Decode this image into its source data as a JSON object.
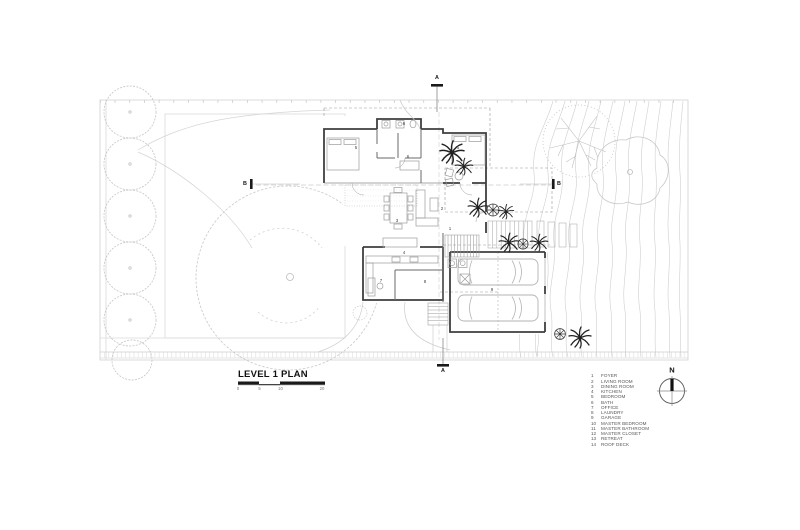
{
  "title_block": {
    "title": "LEVEL 1 PLAN",
    "scale_ticks": [
      "0",
      "5",
      "10",
      "20"
    ]
  },
  "north": {
    "label": "N"
  },
  "sections": {
    "a": "A",
    "b": "B"
  },
  "legend": {
    "items": [
      {
        "num": "1",
        "label": "FOYER"
      },
      {
        "num": "2",
        "label": "LIVING ROOM"
      },
      {
        "num": "3",
        "label": "DINING ROOM"
      },
      {
        "num": "4",
        "label": "KITCHEN"
      },
      {
        "num": "5",
        "label": "BEDROOM"
      },
      {
        "num": "6",
        "label": "BATH"
      },
      {
        "num": "7",
        "label": "OFFICE"
      },
      {
        "num": "8",
        "label": "LAUNDRY"
      },
      {
        "num": "9",
        "label": "GARAGE"
      },
      {
        "num": "10",
        "label": "MASTER BEDROOM"
      },
      {
        "num": "11",
        "label": "MASTER BATHROOM"
      },
      {
        "num": "12",
        "label": "MASTER CLOSET"
      },
      {
        "num": "13",
        "label": "RETREAT"
      },
      {
        "num": "14",
        "label": "ROOF DECK"
      }
    ]
  },
  "plan": {
    "room_labels": [
      "5",
      "6",
      "6",
      "5",
      "2",
      "3",
      "1",
      "4",
      "7",
      "8",
      "9"
    ]
  }
}
